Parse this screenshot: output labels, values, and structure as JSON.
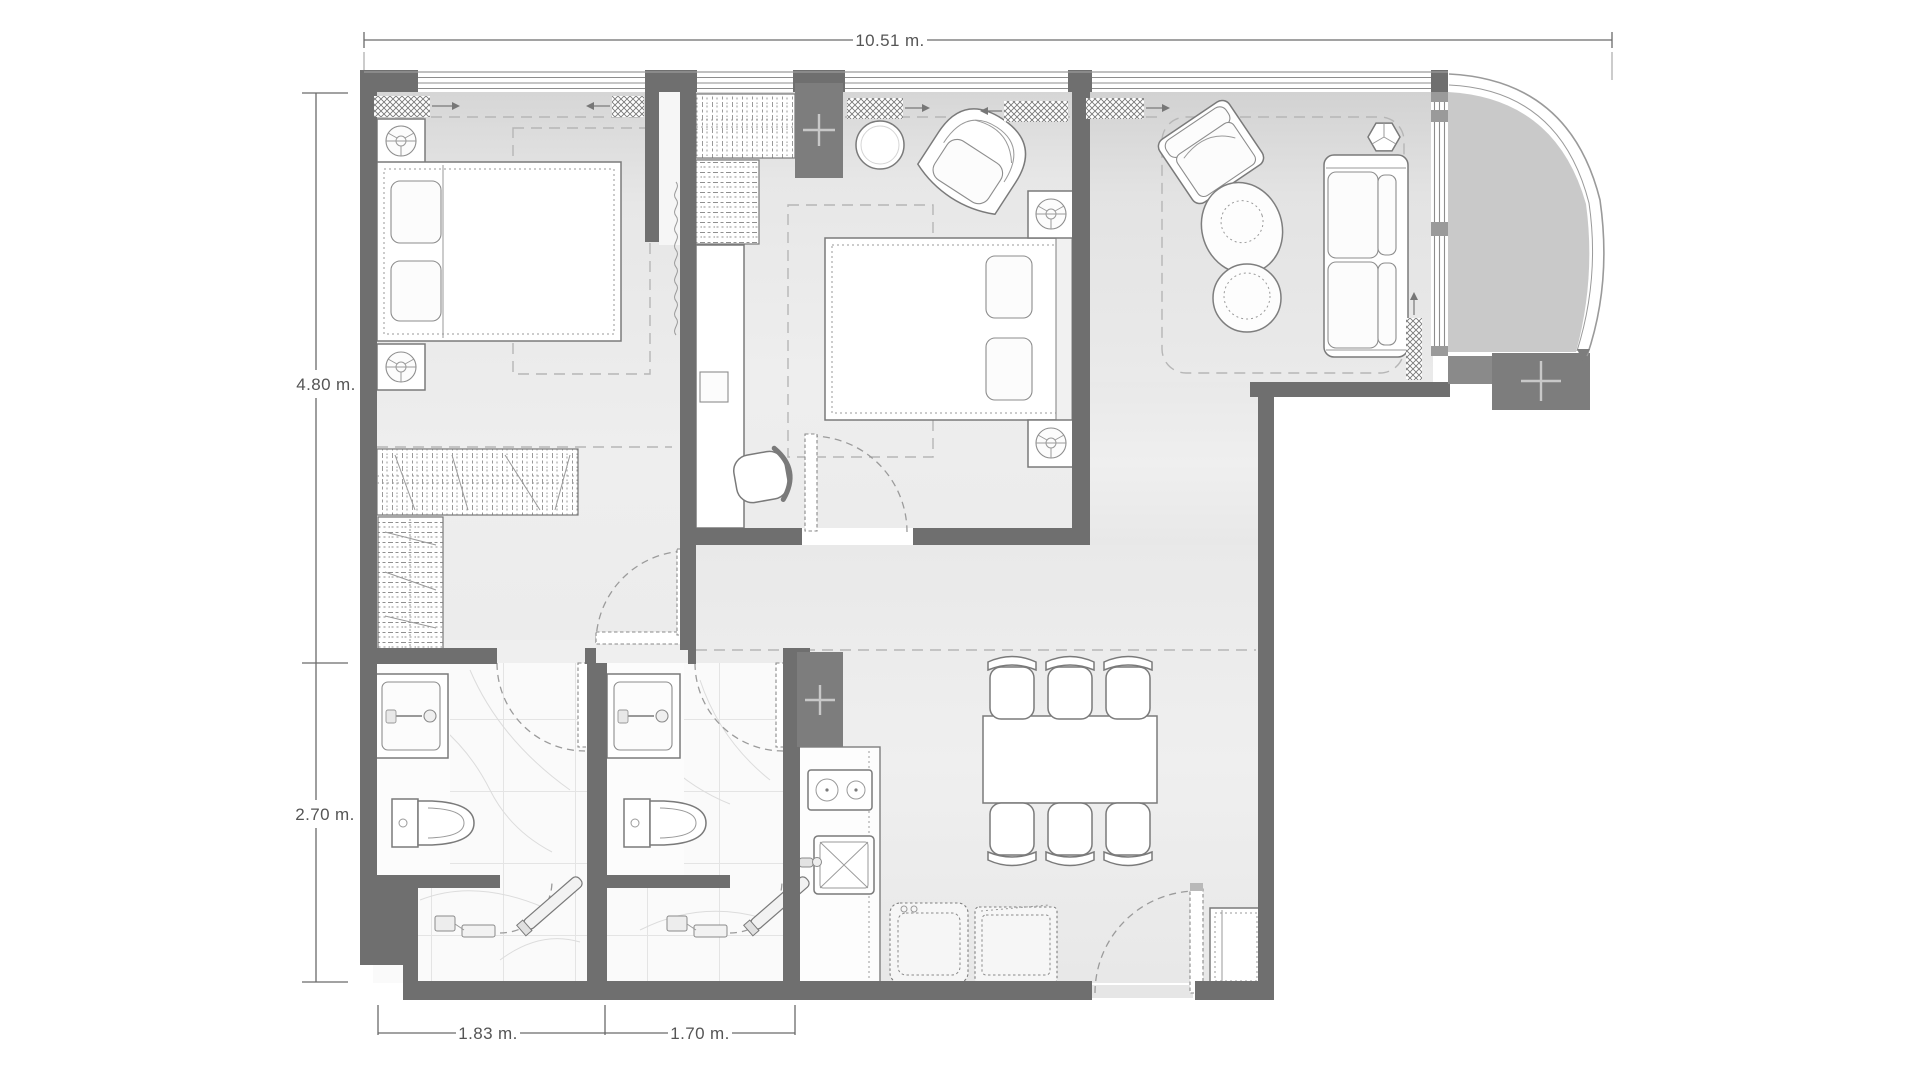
{
  "floor_plan": {
    "dimension_labels": {
      "top": "10.51 m.",
      "left_upper": "4.80 m.",
      "left_lower": "2.70 m.",
      "bottom_left": "1.83 m.",
      "bottom_right": "1.70 m."
    },
    "colors": {
      "wall": "#6f6f6f",
      "floor": "#ececec",
      "bathroom_floor": "#fafafa",
      "balcony_floor": "#c9c9c9",
      "furniture_outline": "#7a7a7a",
      "dimension_text": "#555555",
      "background": "#ffffff"
    }
  }
}
